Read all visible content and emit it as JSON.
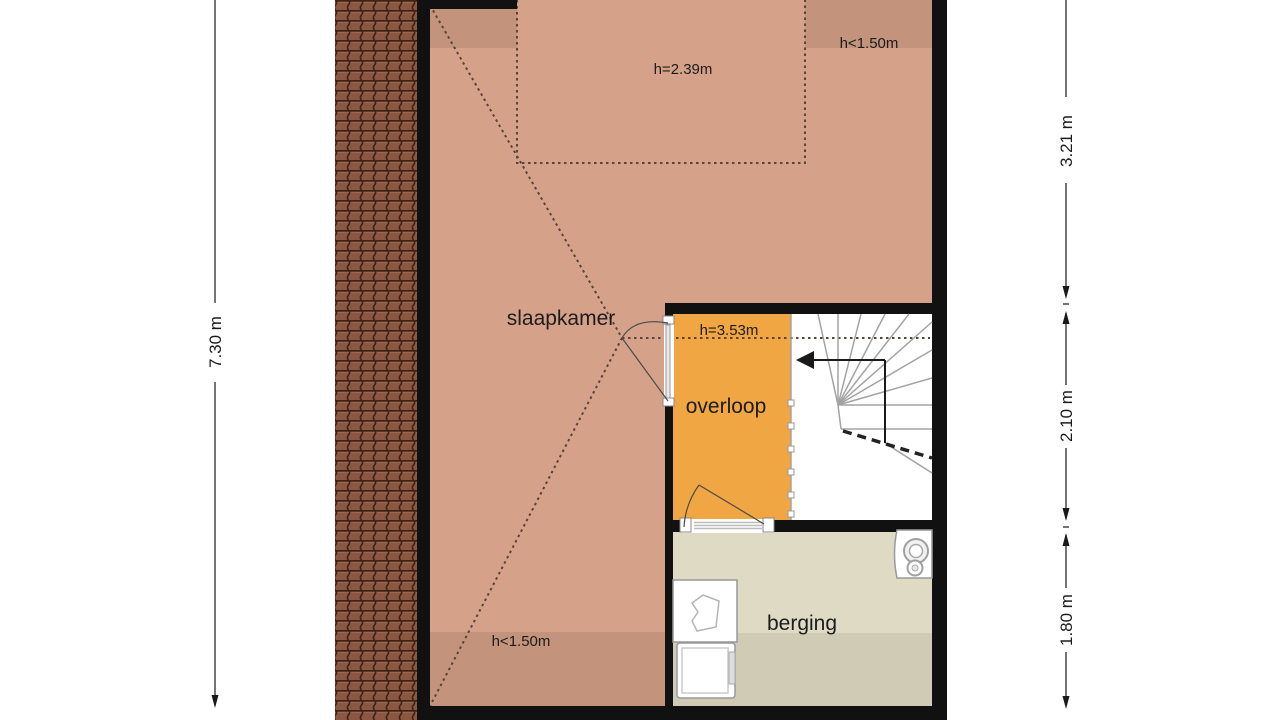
{
  "plan": {
    "rooms": {
      "bedroom": {
        "label": "slaapkamer"
      },
      "landing": {
        "label": "overloop"
      },
      "storage": {
        "label": "berging"
      }
    },
    "height_labels": {
      "bedroom_zone": "h=2.39m",
      "top_right": "h<1.50m",
      "bottom_left": "h<1.50m",
      "landing": "h=3.53m"
    },
    "dimensions": {
      "left_total": "7.30 m",
      "right_top": "3.21 m",
      "right_middle": "2.10 m",
      "right_bottom": "1.80 m"
    },
    "colors": {
      "bedroom_fill": "#d5a289",
      "bedroom_low_fill": "#c4937b",
      "landing_fill": "#f0a643",
      "stair_fill": "#ffffff",
      "storage_fill": "#dedac4",
      "storage_low_fill": "#cfcbb4",
      "wall": "#111111",
      "roof_tile": "#8a5743",
      "stair_line": "#a3a3a3",
      "dash_line": "#564538",
      "dim_line": "#2a2a2a"
    }
  }
}
